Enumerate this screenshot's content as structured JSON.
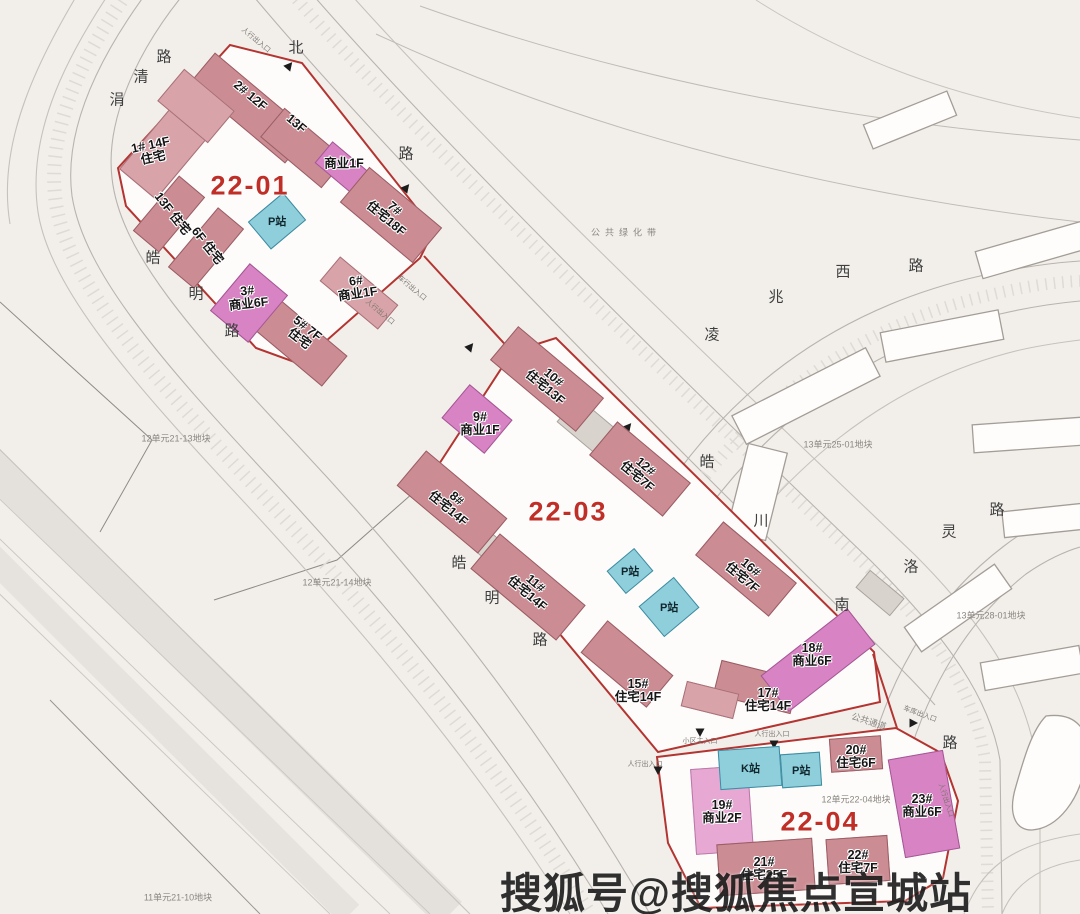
{
  "watermark": "搜狐号@搜狐焦点宣城站",
  "plots": [
    {
      "label": "22-01"
    },
    {
      "label": "22-03"
    },
    {
      "label": "22-04"
    }
  ],
  "building_labels": [
    {
      "l1": "2# 12F",
      "l2": ""
    },
    {
      "l1": "13F",
      "l2": ""
    },
    {
      "l1": "商业1F",
      "l2": ""
    },
    {
      "l1": "1# 14F",
      "l2": "住宅"
    },
    {
      "l1": "13F 住宅",
      "l2": ""
    },
    {
      "l1": "6F 住宅",
      "l2": ""
    },
    {
      "l1": "3#",
      "l2": "商业6F"
    },
    {
      "l1": "5# 7F",
      "l2": "住宅"
    },
    {
      "l1": "6#",
      "l2": "商业1F"
    },
    {
      "l1": "7#",
      "l2": "住宅18F"
    },
    {
      "l1": "10#",
      "l2": "住宅13F"
    },
    {
      "l1": "9#",
      "l2": "商业1F"
    },
    {
      "l1": "8#",
      "l2": "住宅14F"
    },
    {
      "l1": "12#",
      "l2": "住宅7F"
    },
    {
      "l1": "11#",
      "l2": "住宅14F"
    },
    {
      "l1": "16#",
      "l2": "住宅7F"
    },
    {
      "l1": "15#",
      "l2": "住宅14F"
    },
    {
      "l1": "17#",
      "l2": "住宅14F"
    },
    {
      "l1": "18#",
      "l2": "商业6F"
    },
    {
      "l1": "19#",
      "l2": "商业2F"
    },
    {
      "l1": "20#",
      "l2": "住宅6F"
    },
    {
      "l1": "21#",
      "l2": "住宅25F"
    },
    {
      "l1": "22#",
      "l2": "住宅7F"
    },
    {
      "l1": "23#",
      "l2": "商业6F"
    }
  ],
  "stations": [
    {
      "label": "P站"
    },
    {
      "label": "P站"
    },
    {
      "label": "P站"
    },
    {
      "label": "K站"
    },
    {
      "label": "P站"
    }
  ],
  "roads": {
    "juanqing": [
      "涓",
      "清",
      "路"
    ],
    "bei": [
      "北",
      "路"
    ],
    "haoming_n": [
      "皓",
      "明",
      "路"
    ],
    "haoming_s": [
      "皓",
      "明",
      "路"
    ],
    "lingzhao_xi": [
      "凌",
      "兆",
      "西",
      "路"
    ],
    "haochuan_nan": [
      "皓",
      "川",
      "南",
      "路"
    ],
    "luoling": [
      "洛",
      "灵",
      "路"
    ]
  },
  "parcel_labels": [
    {
      "text": "公共绿化带"
    },
    {
      "text": "12单元21-13地块"
    },
    {
      "text": "12单元21-14地块"
    },
    {
      "text": "11单元21-10地块"
    },
    {
      "text": "13单元25-01地块"
    },
    {
      "text": "13单元28-01地块"
    },
    {
      "text": "12单元22-04地块"
    },
    {
      "text": "公共通道"
    }
  ],
  "entrances": [
    {
      "text": "人行出入口"
    },
    {
      "text": "车行出入口"
    },
    {
      "text": "人行出入口"
    },
    {
      "text": "小区主入口"
    },
    {
      "text": "人行出入口"
    },
    {
      "text": "车库出入口"
    },
    {
      "text": "人行出入口"
    },
    {
      "text": "人行出入口"
    }
  ],
  "legend_colors": {
    "residential": "#cb8d93",
    "commercial": "#d883c3",
    "station": "#8fcfdc",
    "plot_boundary": "#b33431",
    "plot_label": "#bf2f28"
  }
}
